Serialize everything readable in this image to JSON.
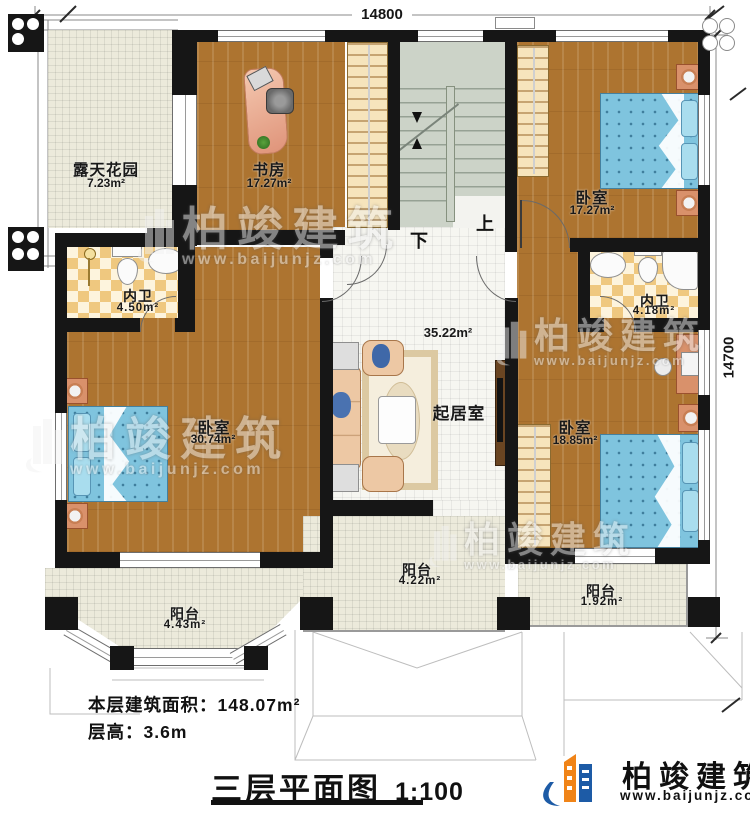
{
  "plan": {
    "dimension_width": "14800",
    "dimension_height": "14700",
    "stair_up": "上",
    "stair_down": "下",
    "rooms": [
      {
        "name": "露天花园",
        "area": "7.23m²"
      },
      {
        "name": "书房",
        "area": "17.27m²"
      },
      {
        "name": "卧室",
        "area": "17.27m²"
      },
      {
        "name": "内卫",
        "area": "4.50m²"
      },
      {
        "name": "卧室",
        "area": "30.74m²"
      },
      {
        "name": "起居室",
        "area": "35.22m²"
      },
      {
        "name": "内卫",
        "area": "4.18m²"
      },
      {
        "name": "卧室",
        "area": "18.85m²"
      },
      {
        "name": "阳台",
        "area": "4.43m²"
      },
      {
        "name": "阳台",
        "area": "4.22m²"
      },
      {
        "name": "阳台",
        "area": "1.92m²"
      }
    ]
  },
  "footer": {
    "floor_area_label": "本层建筑面积：",
    "floor_area_value": "148.07m²",
    "floor_height_label": "层高：",
    "floor_height_value": "3.6m",
    "plan_title": "三层平面图",
    "plan_scale": "1:100"
  },
  "brand": {
    "name": "柏竣建筑",
    "website": "www.baijunjz.com"
  },
  "watermark": {
    "name": "柏竣建筑",
    "website": "www.baijunjz.com"
  },
  "colors": {
    "wall": "#161616",
    "wood": "#ad7430",
    "tile": "#f6f6f1",
    "checker": "#efc87f",
    "outdoor": "#eceadb",
    "stairs": "#ccd3c8",
    "bed": "#7fc4de",
    "accent_blue": "#1d5ba6",
    "accent_orange": "#f08418"
  }
}
